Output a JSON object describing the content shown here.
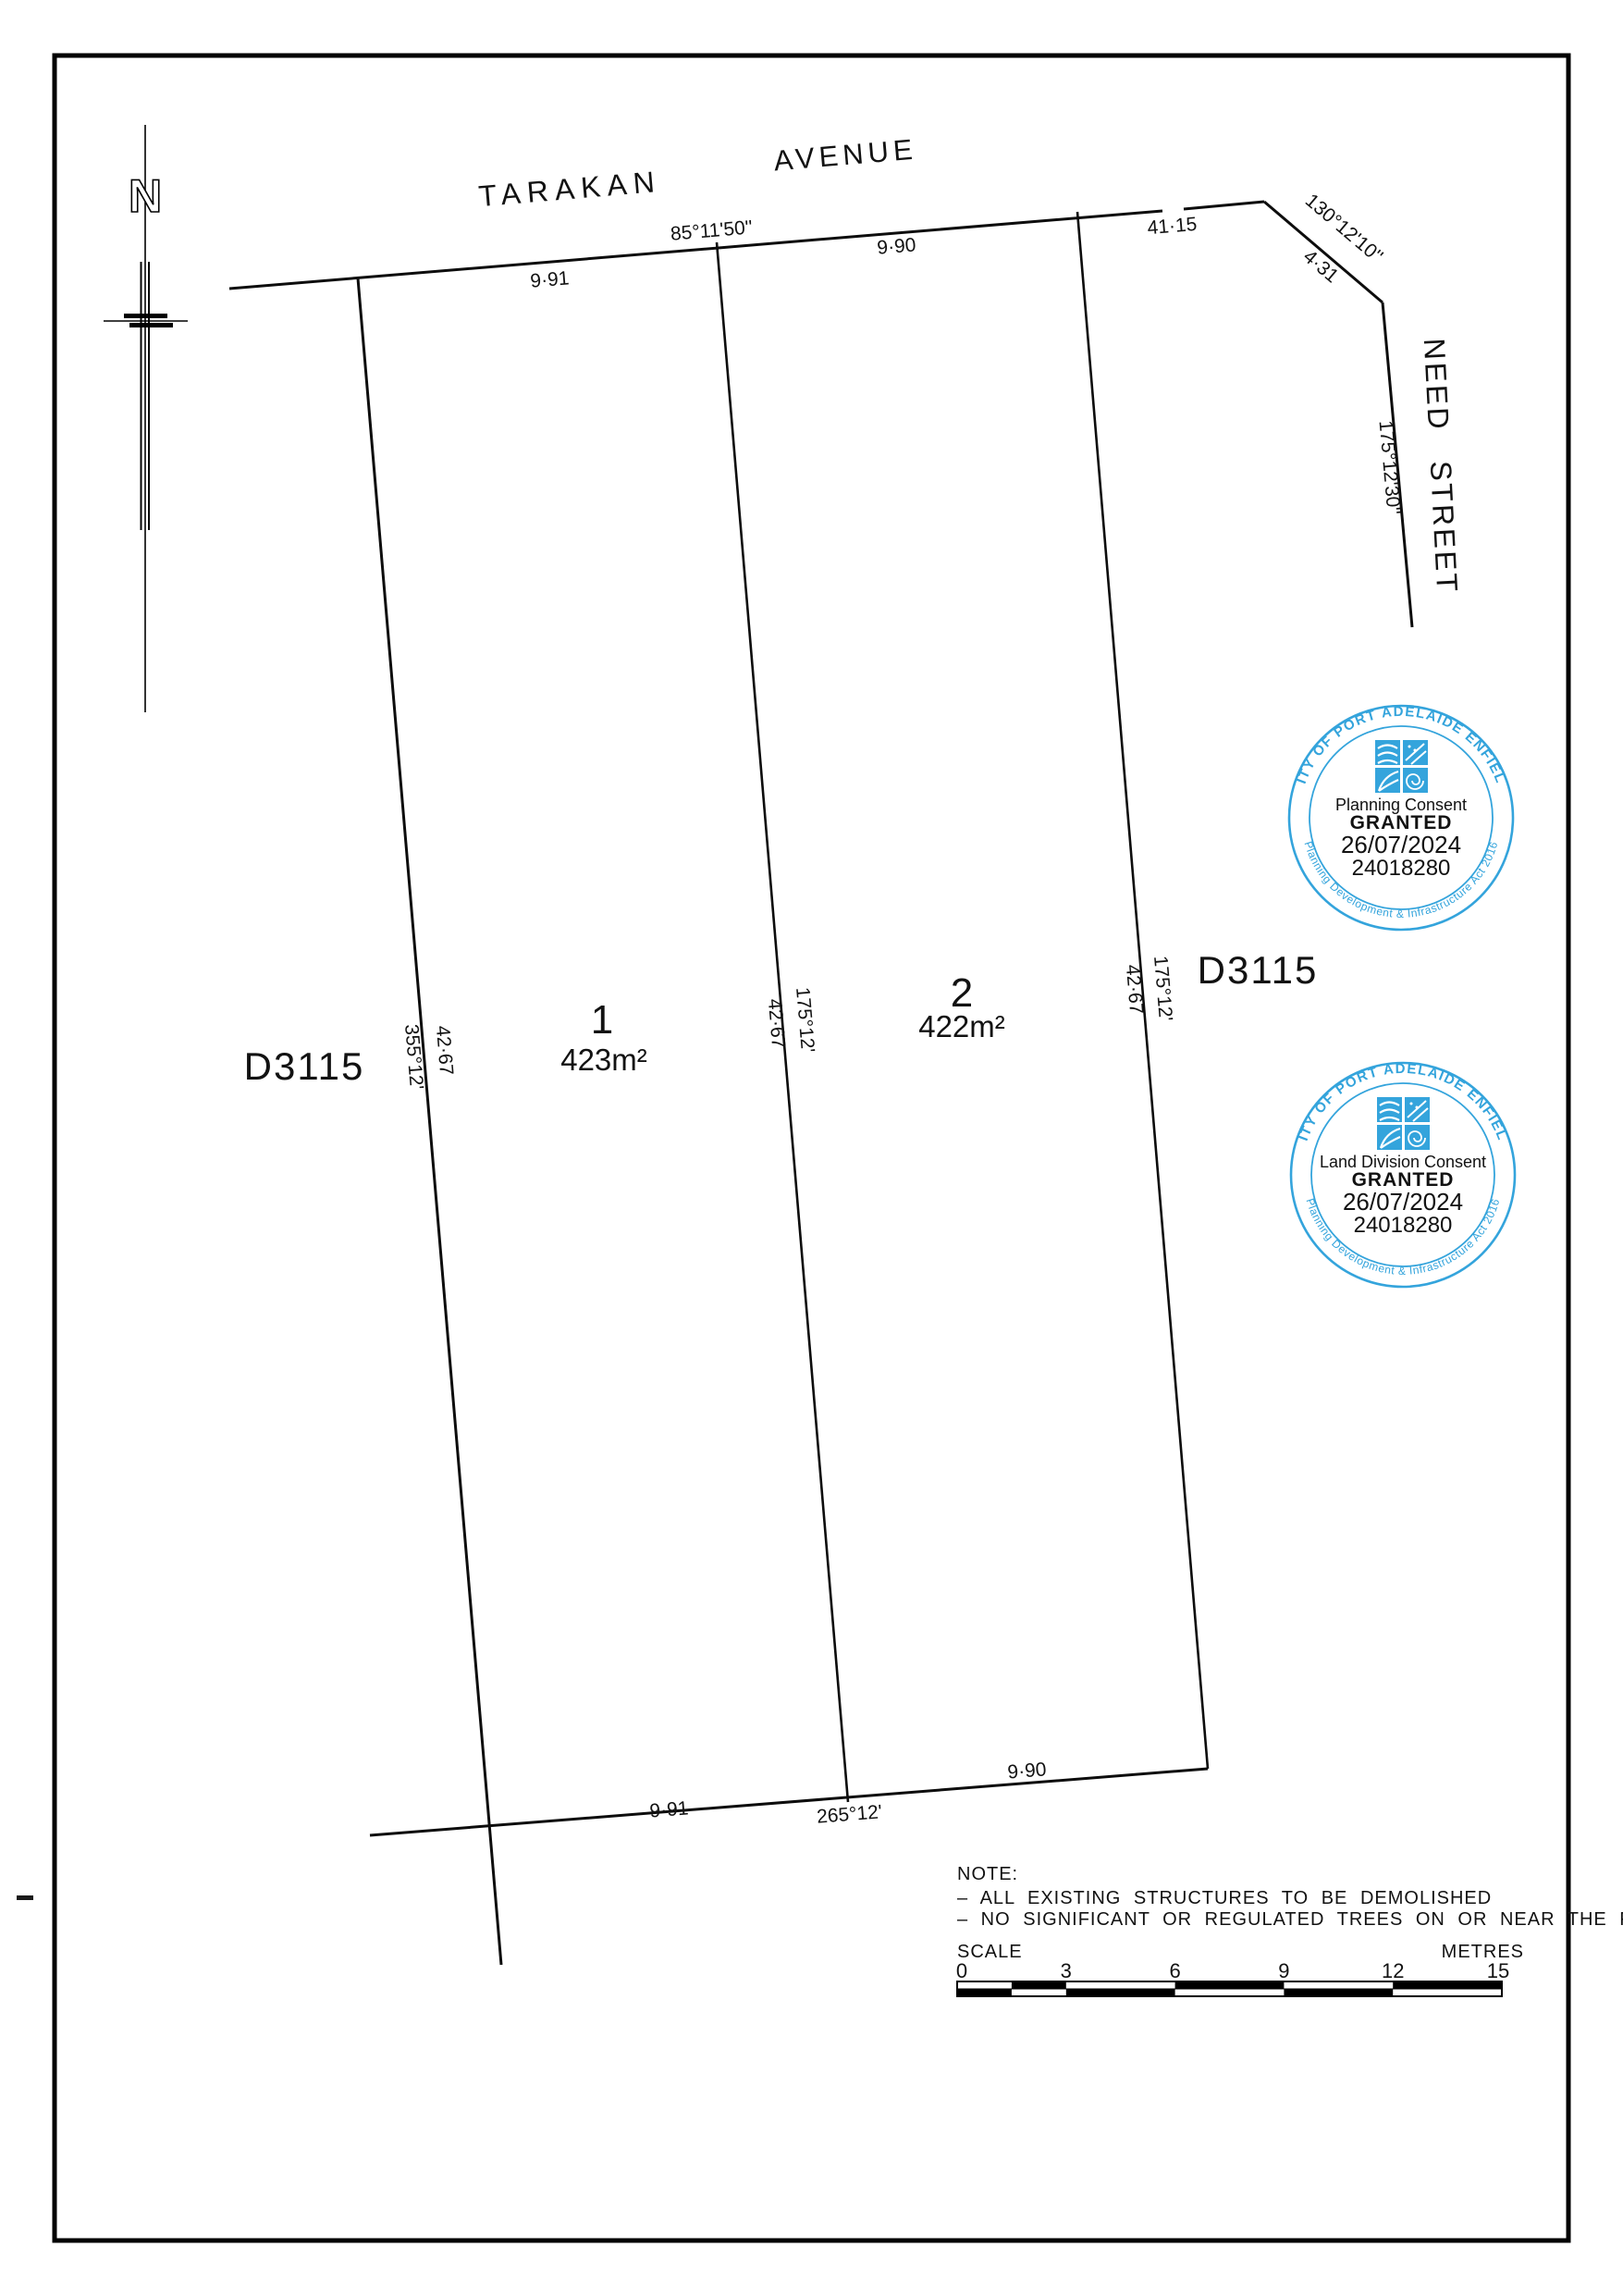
{
  "streets": {
    "tarakan_word1": "TARAKAN",
    "tarakan_word2": "AVENUE",
    "need": "NEED STREET"
  },
  "north": {
    "label": "N"
  },
  "plan_numbers": {
    "left": "D3115",
    "right": "D3115"
  },
  "lots": [
    {
      "number": "1",
      "area": "423m²"
    },
    {
      "number": "2",
      "area": "422m²"
    }
  ],
  "dimensions": {
    "top_bearing": "85°11'50''",
    "top_frontage_lot1": "9·91",
    "top_frontage_lot2": "9·90",
    "street_traverse": "41·15",
    "corner_bearing": "130°12'10''",
    "corner_distance": "4·31",
    "need_bearing": "175°12'30''",
    "west_bearing": "355°12'",
    "west_distance": "42·67",
    "mid_distance": "42·67",
    "mid_bearing": "175°12'",
    "east_distance": "42·67",
    "east_bearing": "175°12'",
    "bottom_lot1": "9·91",
    "bottom_bearing": "265°12'",
    "bottom_lot2": "9·90"
  },
  "stamps": [
    {
      "ring": "CITY OF PORT ADELAIDE ENFIELD",
      "type": "Planning Consent",
      "status": "GRANTED",
      "date": "26/07/2024",
      "number": "24018280",
      "act": "Planning Development & Infrastructure Act 2016",
      "color": "#34a4dc"
    },
    {
      "ring": "CITY OF PORT ADELAIDE ENFIELD",
      "type": "Land Division Consent",
      "status": "GRANTED",
      "date": "26/07/2024",
      "number": "24018280",
      "act": "Planning Development & Infrastructure Act 2016",
      "color": "#34a4dc"
    }
  ],
  "note": {
    "title": "NOTE:",
    "line1": "–  ALL EXISTING STRUCTURES TO BE DEMOLISHED",
    "line2": "–  NO SIGNIFICANT OR REGULATED TREES ON OR NEAR THE PROPERTY"
  },
  "scalebar": {
    "label": "SCALE",
    "units": "METRES",
    "t0": "0",
    "t3": "3",
    "t6": "6",
    "t9": "9",
    "t12": "12",
    "t15": "15"
  }
}
